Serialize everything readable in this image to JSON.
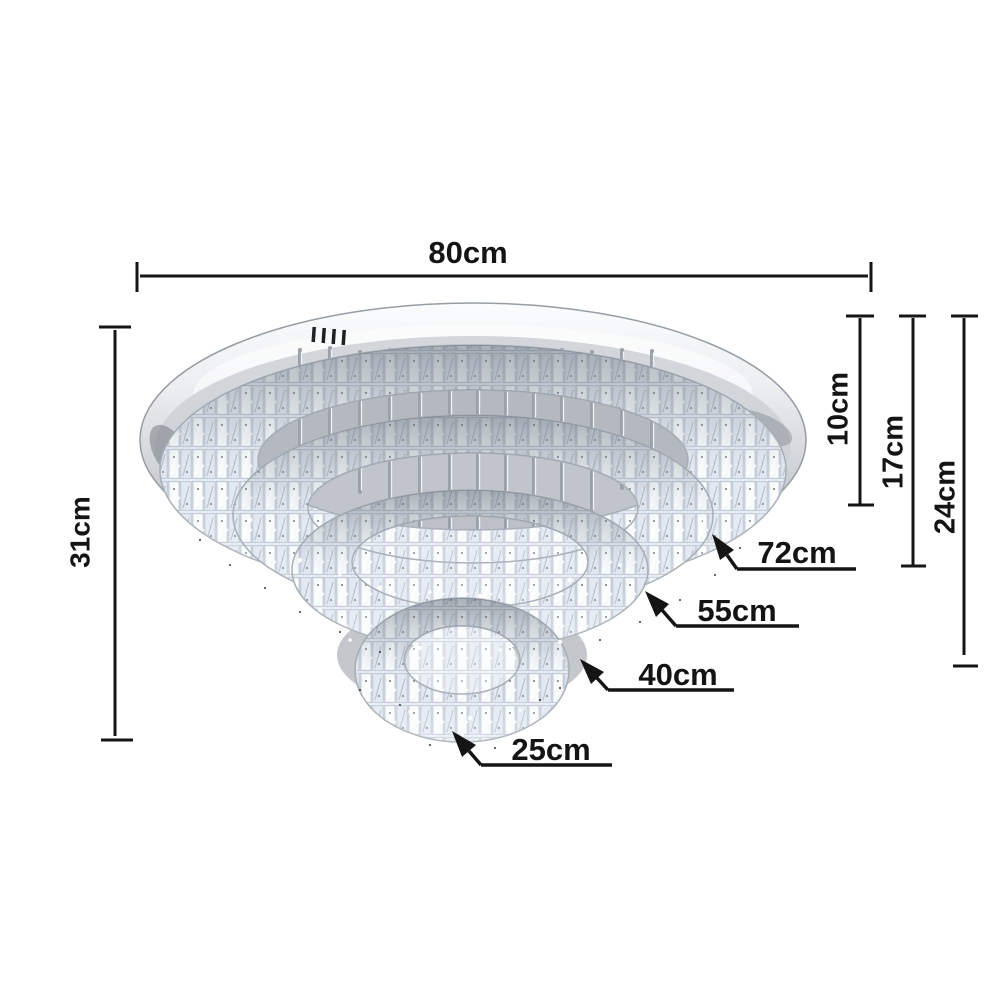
{
  "diagram": {
    "subject": "Five-tier round crystal LED flush-mount ceiling chandelier on a chrome base plate",
    "dimensions": {
      "overall_width": "80cm",
      "overall_height": "31cm",
      "tier_offsets": [
        {
          "id": "tier-1-height",
          "label": "10cm"
        },
        {
          "id": "tier-2-height",
          "label": "17cm"
        },
        {
          "id": "tier-3-height",
          "label": "24cm"
        }
      ],
      "ring_diameters": [
        {
          "id": "ring-1",
          "label": "72cm"
        },
        {
          "id": "ring-2",
          "label": "55cm"
        },
        {
          "id": "ring-3",
          "label": "40cm"
        },
        {
          "id": "ring-4",
          "label": "25cm"
        }
      ]
    },
    "colors": {
      "background": "#ffffff",
      "annotation": "#151515",
      "chrome_light": "#fbfcfd",
      "chrome_mid": "#d6d9dc",
      "chrome_dark": "#a5aab0",
      "crystal_base": "#eef2f7",
      "shadow_gray": "#b9bdc3"
    }
  }
}
